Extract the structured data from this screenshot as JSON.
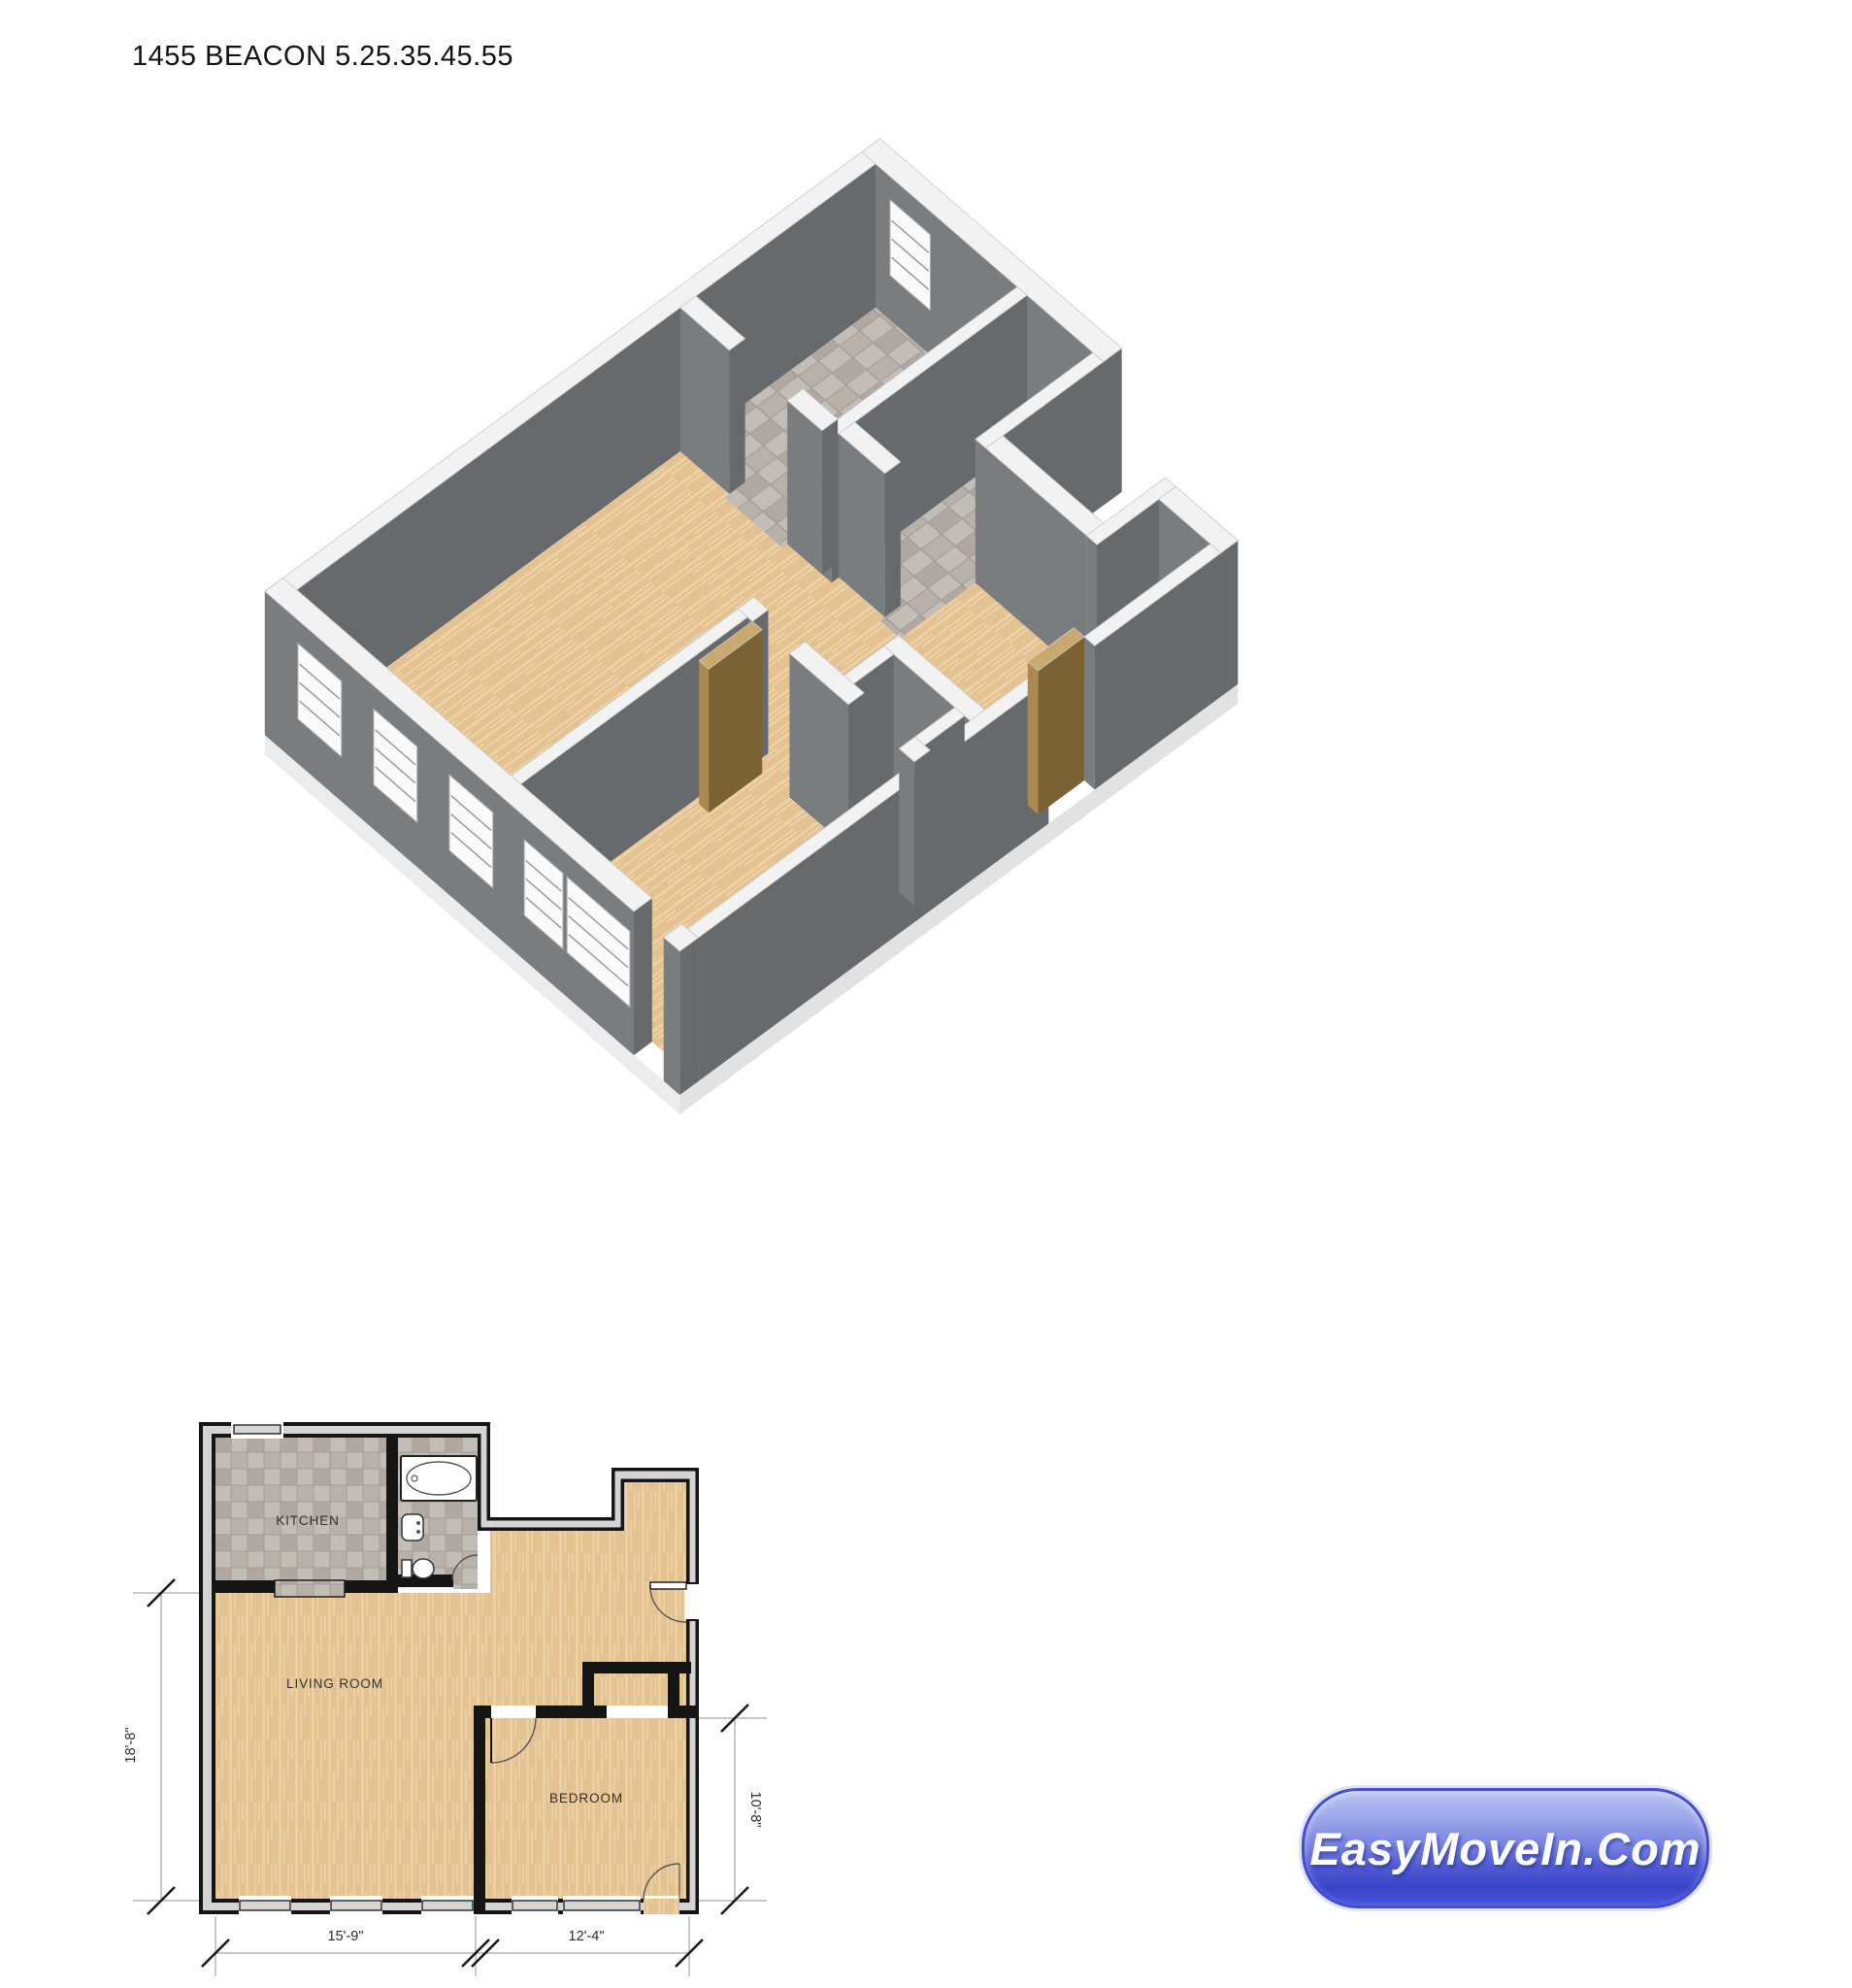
{
  "title": "1455 BEACON 5.25.35.45.55",
  "plan2d": {
    "rooms": {
      "kitchen": "KITCHEN",
      "living": "LIVING ROOM",
      "bedroom": "BEDROOM"
    },
    "dimensions": {
      "left": "18'-8\"",
      "bottom_left": "15'-9\"",
      "bottom_right": "12'-4\"",
      "right": "10'-8\""
    }
  },
  "iso_view": {
    "description": "3D isometric cutaway of unit",
    "floors": {
      "wood": "#eccfa2",
      "tile": "#c3bdb8"
    },
    "walls": {
      "face_left": "#7a7d80",
      "face_right": "#666a6d",
      "top": "#f2f2f2"
    },
    "door_color": "#ab8a4f"
  },
  "logo": {
    "text": "EasyMoveIn.Com",
    "accent": "#3a43c6"
  }
}
